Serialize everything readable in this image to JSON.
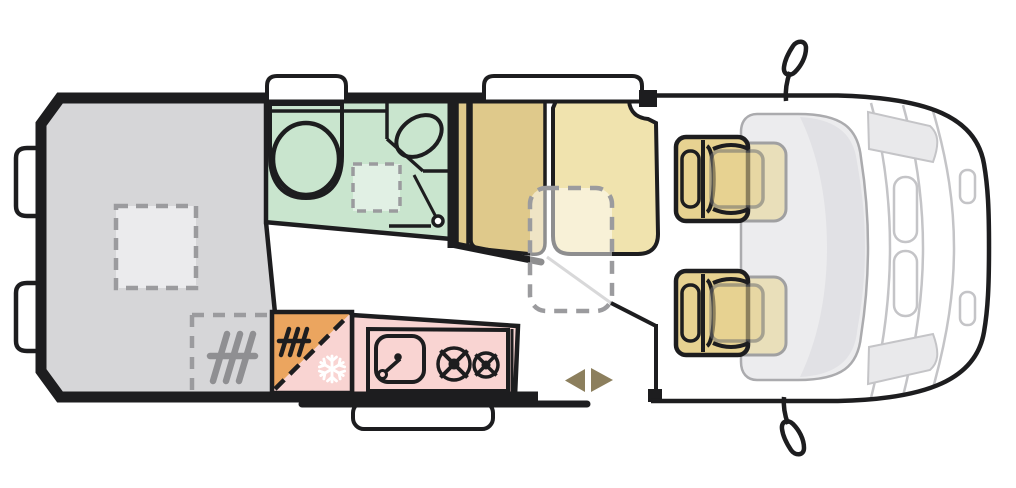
{
  "diagram": {
    "title": "Campervan floor plan — top view",
    "colors": {
      "outline": "#1d1d1f",
      "bed": "#d6d6d8",
      "skylight": "#ebebed",
      "bathroom": "#c9e5ce",
      "shower_tray": "#e1f0e4",
      "bench_seat": "#dfc98b",
      "lounge_seat": "#f0e3ae",
      "table_overlay": "rgba(255,255,255,0.5)",
      "cab_seat": "#e7d291",
      "ghost_seat": "#e9dcae",
      "kitchen": "#f9d4d2",
      "fridge": "#eba55f",
      "snowflake": "#ffffff",
      "heater_dark": "#1d1d1f",
      "heater_gray": "#8f8f92",
      "door_arrow": "#8c7f5d",
      "dash_gray": "#9b9b9e",
      "body_line": "#c4c4c7",
      "cab_interior": "#ececee",
      "windshield": "#dfdfe3",
      "window_fill": "#ffffff"
    },
    "legend": {
      "bed": "rear transverse bed",
      "bathroom": "washroom with toilet, basin and shower",
      "dinette": "dinette bench with removable table",
      "kitchen": "kitchen unit with sink and two-burner hob",
      "fridge": "fridge / heater compartment",
      "entry": "sliding-door entry with step",
      "cab": "cab with driver and passenger seats"
    }
  }
}
